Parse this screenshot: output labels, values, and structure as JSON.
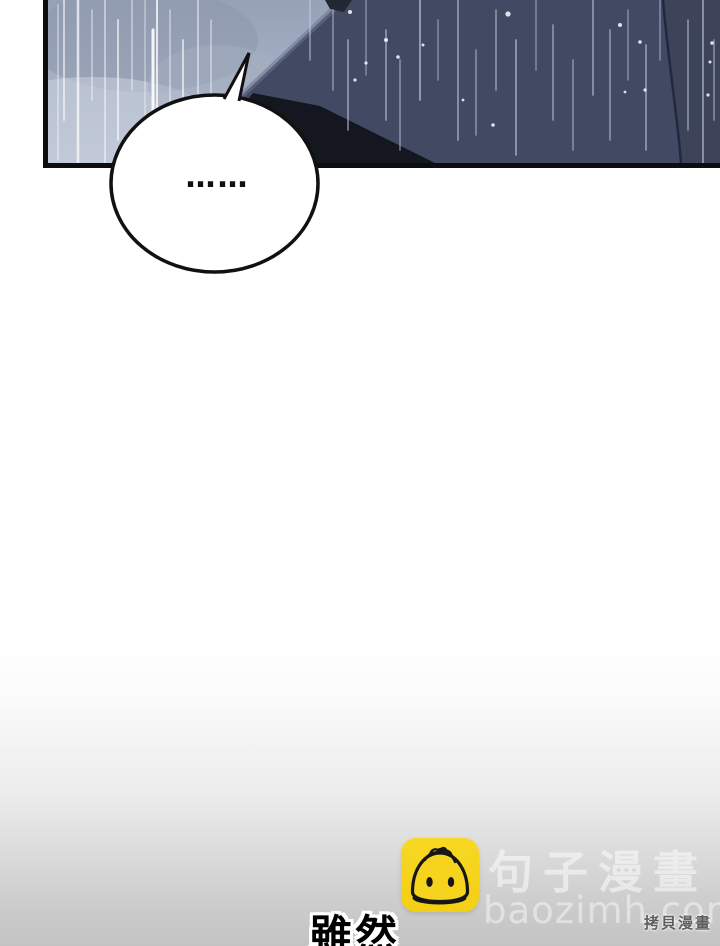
{
  "comic_panel": {
    "description": "rainy night scene with dark cloaked silhouette",
    "colors": {
      "sky_light": "#9aa4b8",
      "sky_light_low": "#b4bdce",
      "sky_dark": "#424a63",
      "silhouette": "#14171f",
      "panel_border": "#0c0d10",
      "rain_light": "#ffffff",
      "rain_dark": "#c7d2ea"
    }
  },
  "speech_bubble": {
    "text": "……"
  },
  "caption": {
    "text": "雖然"
  },
  "watermark": {
    "site_name": "句子漫畫",
    "site_url": "baozimh.com",
    "icon": "baozi-bun-icon",
    "icon_color": "#f6d31d"
  },
  "footer": {
    "source_label": "拷貝漫畫"
  }
}
